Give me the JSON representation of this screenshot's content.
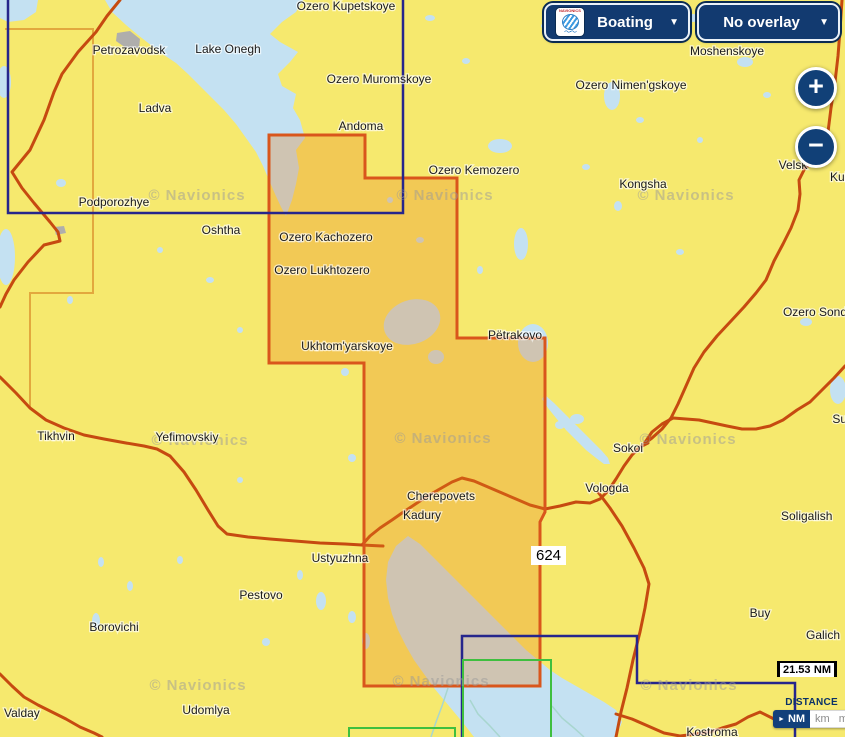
{
  "header": {
    "boating_label": "Boating",
    "overlay_label": "No overlay",
    "caret": "▼",
    "logo_brand": "NAVIONICS",
    "logo_waves": "〜〜"
  },
  "zoom_controls": {
    "zoom_in": "+",
    "zoom_out": "−"
  },
  "scale_bar": {
    "value": "21.53",
    "unit": "NM"
  },
  "distance_panel": {
    "title": "DISTANCE",
    "selected_marker": "►",
    "selected_unit": "NM",
    "other_units": [
      "km",
      "mi"
    ]
  },
  "map": {
    "region_label": "624",
    "watermark_text": "© Navionics",
    "colors": {
      "land": "#F6E96E",
      "water": "#C4E1F2",
      "overlay_fill": "#E8821E",
      "overlay_border": "#D9561C",
      "navy": "#26268C",
      "green": "#3FBF3F",
      "boundary": "#E2A83E",
      "road": "#C64A10",
      "river": "#A8D6CF",
      "city": "#AFAEAC",
      "label": "#1A1A1A",
      "watermark": "#9A9A9A"
    },
    "region_polygon": "269,135 365,135 365,178 457,178 457,338 545,338 545,512 540,522 540,686 364,686 364,363 269,363",
    "navy_lines": [
      "8,0 8,213 403,213 403,0",
      "462,737 462,636 637,636 637,683 795,683 795,737"
    ],
    "green_lines": [
      "463,737 463,660 551,660 551,737",
      "349,737 349,728 455,728 455,737"
    ],
    "boundary_line": "5,29 93,29 93,293 30,293 30,408",
    "roads": [
      "120,0 107,16 96,32 78,52 62,74 54,92 44,120 30,150 12,172 22,188 34,203 50,222 58,232 60,241 44,245 28,262 14,280 6,294 0,307",
      "0,377 16,393 30,408 46,420 64,428 84,435 104,439 126,443 144,446 157,449 170,456 184,472 196,490 208,510 218,526 227,534 248,537 270,539 295,541 320,543 345,544 362,545 383,546",
      "362,545 370,536 380,528 392,520 402,513 414,505 426,497 438,490 452,482 462,478 474,481 488,487 502,493 516,499 530,505 545,509 560,506 576,502 590,503 600,499 608,491 616,479 624,466 632,455 640,447 648,443",
      "842,0 840,30 838,56 835,82 831,108 828,132 826,150 816,160 805,168 799,180 800,194 798,210 791,228 783,244 774,261 766,280 756,293 744,307 731,321 717,336 704,352 694,368 686,386 678,404 671,418 662,429 652,438 644,444",
      "845,366 834,378 822,390 810,402 797,410 783,420 770,426 756,429 742,429 727,426 713,423 699,420 686,419 673,418 662,424 652,432 644,444",
      "598,492 610,508 622,526 634,548 644,568 649,584 645,608 640,632 633,660 627,688 621,712 616,737",
      "616,714 632,719 648,726 664,733 680,736 696,734 710,732 722,728 736,724 748,717 760,712 772,718 784,724 796,719 808,712 820,716 832,722 845,721",
      "0,674 12,686 24,697 38,705 52,712 66,719 80,727 94,733 102,737"
    ],
    "rivers": [
      "448,688 442,706 436,722 431,737",
      "470,700 478,714 490,726 500,737",
      "552,706 562,718 574,728 584,737"
    ],
    "water_polygons": [
      "105,0 112,12 126,25 138,35 152,46 164,55 176,63 188,74 200,86 212,98 224,110 236,124 246,138 256,152 263,166 269,180 275,194 281,207 286,216 292,200 296,184 299,168 296,150 305,138 300,120 293,108 296,94 282,86 278,74 290,62 298,52 280,42 270,34 282,22 296,12 303,0",
      "408,536 420,544 432,556 444,568 458,582 472,596 486,610 500,624 514,638 526,650 538,660 550,670 562,678 576,686 590,694 604,702 616,710 622,722 616,737 474,737 464,724 454,712 444,700 434,688 424,674 414,660 406,646 398,630 392,614 388,598 386,580 388,562 396,546",
      "545,395 554,403 564,413 574,423 584,433 594,443 602,451 608,458 610,464 604,464 596,458 586,450 576,440 566,430 556,418 548,408 542,399",
      "0,0 38,0 36,12 24,20 8,22 0,18"
    ],
    "lakes": [
      [
        500,
        146,
        12,
        7,
        0
      ],
      [
        521,
        244,
        7,
        16,
        0
      ],
      [
        533,
        343,
        15,
        19,
        0
      ],
      [
        577,
        419,
        7,
        5,
        0
      ],
      [
        612,
        96,
        8,
        14,
        0
      ],
      [
        600,
        19,
        6,
        5,
        0
      ],
      [
        745,
        62,
        8,
        5,
        0
      ],
      [
        693,
        18,
        5,
        4,
        0
      ],
      [
        4,
        82,
        7,
        16,
        0
      ],
      [
        6,
        257,
        9,
        28,
        0
      ],
      [
        61,
        183,
        5,
        4,
        0
      ],
      [
        412,
        322,
        29,
        22,
        -20
      ],
      [
        436,
        357,
        8,
        7,
        0
      ],
      [
        345,
        372,
        4,
        4,
        0
      ],
      [
        352,
        458,
        4,
        4,
        0
      ],
      [
        96,
        621,
        4,
        8,
        0
      ],
      [
        321,
        601,
        5,
        9,
        0
      ],
      [
        352,
        617,
        4,
        6,
        0
      ],
      [
        366,
        641,
        4,
        8,
        0
      ],
      [
        266,
        642,
        4,
        4,
        0
      ],
      [
        130,
        586,
        3,
        5,
        0
      ],
      [
        101,
        562,
        3,
        5,
        0
      ],
      [
        806,
        322,
        6,
        4,
        0
      ],
      [
        838,
        390,
        8,
        14,
        0
      ],
      [
        680,
        252,
        4,
        3,
        0
      ],
      [
        560,
        425,
        5,
        4,
        0
      ],
      [
        430,
        18,
        5,
        3,
        0
      ],
      [
        466,
        61,
        4,
        3,
        0
      ],
      [
        545,
        26,
        4,
        3,
        0
      ],
      [
        640,
        120,
        4,
        3,
        0
      ],
      [
        586,
        167,
        4,
        3,
        0
      ],
      [
        618,
        206,
        4,
        5,
        0
      ],
      [
        767,
        95,
        4,
        3,
        0
      ],
      [
        700,
        140,
        3,
        3,
        0
      ],
      [
        300,
        575,
        3,
        5,
        0
      ],
      [
        210,
        280,
        4,
        3,
        0
      ],
      [
        240,
        330,
        3,
        3,
        0
      ],
      [
        160,
        250,
        3,
        3,
        0
      ],
      [
        70,
        300,
        3,
        4,
        0
      ],
      [
        180,
        560,
        3,
        4,
        0
      ],
      [
        240,
        480,
        3,
        3,
        0
      ],
      [
        300,
        240,
        3,
        3,
        0
      ],
      [
        420,
        240,
        4,
        3,
        0
      ],
      [
        390,
        200,
        3,
        3,
        0
      ],
      [
        480,
        270,
        3,
        4,
        0
      ]
    ],
    "cities": [
      "117,33 130,31 140,39 139,48 126,48 116,41",
      "54,227 64,226 66,233 56,235"
    ],
    "watermarks": [
      [
        197,
        200
      ],
      [
        445,
        200
      ],
      [
        686,
        200
      ],
      [
        200,
        445
      ],
      [
        443,
        443
      ],
      [
        688,
        444
      ],
      [
        198,
        690
      ],
      [
        441,
        686
      ],
      [
        689,
        690
      ]
    ],
    "labels": [
      {
        "text": "Ozero Kupetskoye",
        "x": 346,
        "y": 10
      },
      {
        "text": "Petrozavodsk",
        "x": 129,
        "y": 54
      },
      {
        "text": "Lake Onegh",
        "x": 228,
        "y": 53
      },
      {
        "text": "Moshenskoye",
        "x": 727,
        "y": 55
      },
      {
        "text": "Ozero Muromskoye",
        "x": 379,
        "y": 83
      },
      {
        "text": "Ozero Nimen'gskoye",
        "x": 631,
        "y": 89
      },
      {
        "text": "Ladva",
        "x": 155,
        "y": 112
      },
      {
        "text": "Andoma",
        "x": 361,
        "y": 130
      },
      {
        "text": "Ozero Kemozero",
        "x": 474,
        "y": 174
      },
      {
        "text": "Kongsha",
        "x": 643,
        "y": 188
      },
      {
        "text": "Velsk",
        "x": 793,
        "y": 169
      },
      {
        "text": "Kulo",
        "x": 830,
        "y": 181,
        "anchor": "start"
      },
      {
        "text": "Podporozhye",
        "x": 114,
        "y": 206
      },
      {
        "text": "Oshtha",
        "x": 221,
        "y": 234
      },
      {
        "text": "Ozero Kachozero",
        "x": 326,
        "y": 241
      },
      {
        "text": "Ozero Lukhtozero",
        "x": 322,
        "y": 274
      },
      {
        "text": "Pëtrakovo",
        "x": 515,
        "y": 339
      },
      {
        "text": "Ozero Sond",
        "x": 847,
        "y": 316,
        "anchor": "end"
      },
      {
        "text": "Ukhtom'yarskoye",
        "x": 347,
        "y": 350
      },
      {
        "text": "Su",
        "x": 847,
        "y": 423,
        "anchor": "end"
      },
      {
        "text": "Tikhvin",
        "x": 56,
        "y": 440
      },
      {
        "text": "Yefimovskiy",
        "x": 187,
        "y": 441
      },
      {
        "text": "Sokoi",
        "x": 628,
        "y": 452
      },
      {
        "text": "Vologda",
        "x": 607,
        "y": 492
      },
      {
        "text": "Cherepovets",
        "x": 441,
        "y": 500
      },
      {
        "text": "Kadury",
        "x": 422,
        "y": 519
      },
      {
        "text": "Soligalish",
        "x": 781,
        "y": 520,
        "anchor": "start"
      },
      {
        "text": "Ustyuzhna",
        "x": 340,
        "y": 562
      },
      {
        "text": "Pestovo",
        "x": 261,
        "y": 599
      },
      {
        "text": "Buy",
        "x": 760,
        "y": 617
      },
      {
        "text": "Borovichi",
        "x": 114,
        "y": 631
      },
      {
        "text": "Galich",
        "x": 823,
        "y": 639
      },
      {
        "text": "Udomlya",
        "x": 206,
        "y": 714
      },
      {
        "text": "Valday",
        "x": 4,
        "y": 717,
        "anchor": "start"
      },
      {
        "text": "Kostroma",
        "x": 712,
        "y": 736
      }
    ]
  }
}
